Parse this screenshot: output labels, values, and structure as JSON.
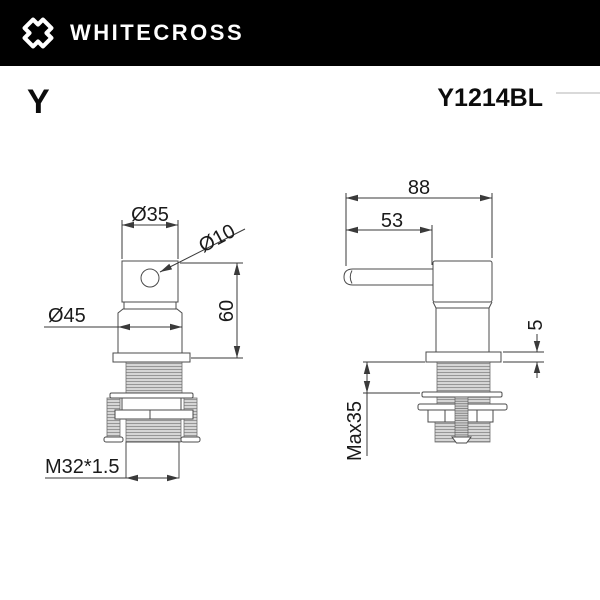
{
  "header": {
    "brand": "WHITECROSS",
    "logo": "x-cross"
  },
  "titlebar": {
    "series": "Y",
    "model": "Y1214BL"
  },
  "front_view": {
    "dims": {
      "hub_diameter": "Ø35",
      "lever_diameter": "Ø10",
      "body_diameter": "Ø45",
      "body_height": "60",
      "thread_spec": "M32*1.5"
    }
  },
  "side_view": {
    "dims": {
      "overall_length": "88",
      "lever_length": "53",
      "flange_thickness": "5",
      "mounting_max": "Max35"
    }
  },
  "colors": {
    "header_bg": "#000000",
    "header_text": "#ffffff",
    "drawing_line": "#4b4b4b",
    "dimension_line": "#3a3a3a",
    "thread_gray": "#8a8a8a"
  }
}
